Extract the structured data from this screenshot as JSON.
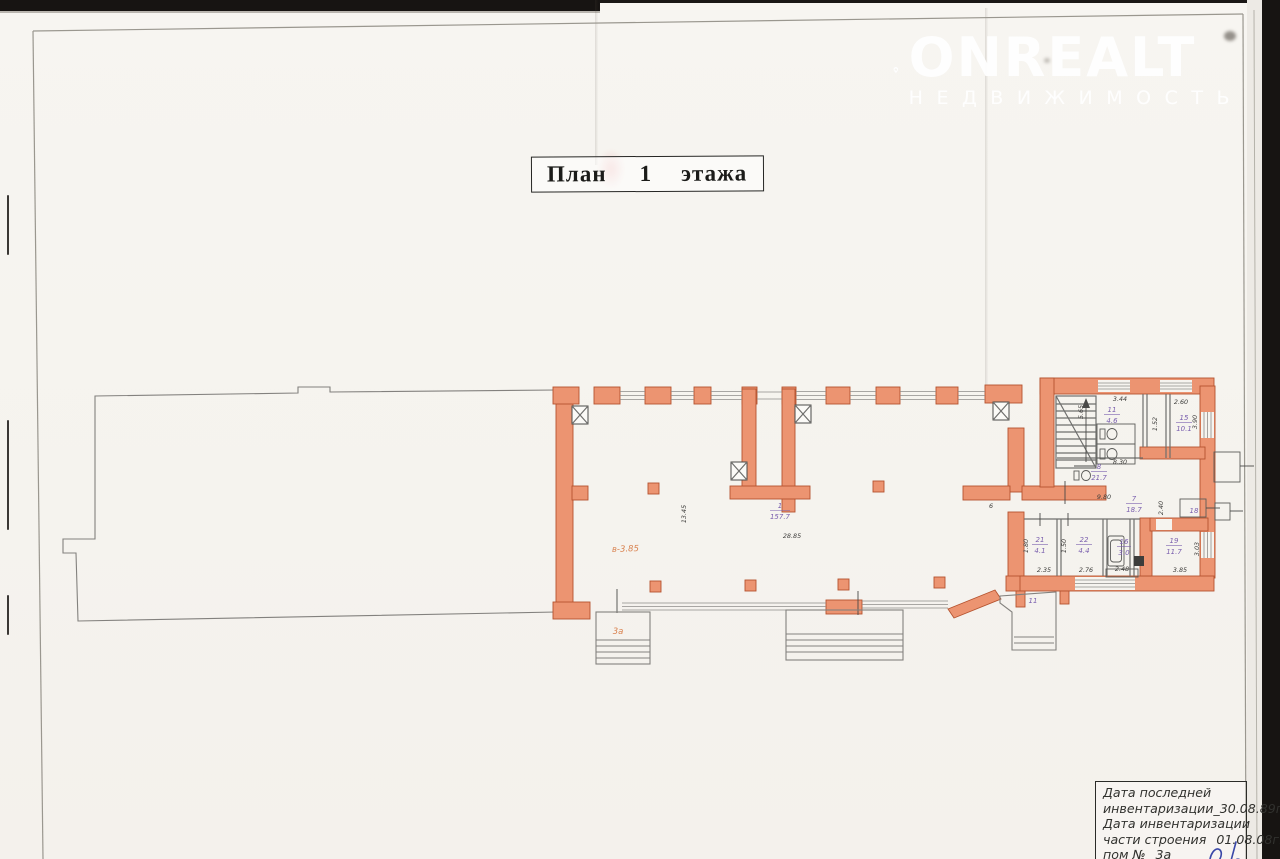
{
  "watermark": {
    "brand": "ONREALT",
    "subtitle": "НЕДВИЖИМОСТЬ"
  },
  "title": {
    "word1": "План",
    "floor": "1",
    "word2": "этажа"
  },
  "plan": {
    "rooms": [
      {
        "num": "1",
        "area": "157.7"
      },
      {
        "num": "11",
        "area": "4.6"
      },
      {
        "num": "15",
        "area": "10.1"
      },
      {
        "num": "8",
        "area": "21.7"
      },
      {
        "num": "7",
        "area": "18.7"
      },
      {
        "num": "18",
        "area": ""
      },
      {
        "num": "21",
        "area": "4.1"
      },
      {
        "num": "22",
        "area": "4.4"
      },
      {
        "num": "16",
        "area": "3.0"
      },
      {
        "num": "19",
        "area": "11.7"
      },
      {
        "num": "11",
        "area": ""
      }
    ],
    "dims": {
      "hall_width": "28.85",
      "hall_depth": "13.45",
      "stub": "6",
      "t344": "3.44",
      "t260": "2.60",
      "t390": "3.90",
      "t152": "1.52",
      "t565": "5.65",
      "t830": "8.30",
      "t980": "9.80",
      "t240": "2.40",
      "b235": "2.35",
      "b276": "2.76",
      "b248": "2.48",
      "b385": "3.85",
      "b303": "3.03",
      "b180": "1.80",
      "b150": "1.50"
    },
    "notes": {
      "height": "в-3.85",
      "porch": "3а"
    }
  },
  "stamp": {
    "line1": "Дата последней",
    "line2": "инвентаризации_30.08.89г.",
    "line3": "Дата инвентаризации",
    "line4_label": "части строения",
    "line4_value": "01.08.08г.",
    "line5_label": "пом №",
    "line5_value": "3а"
  }
}
